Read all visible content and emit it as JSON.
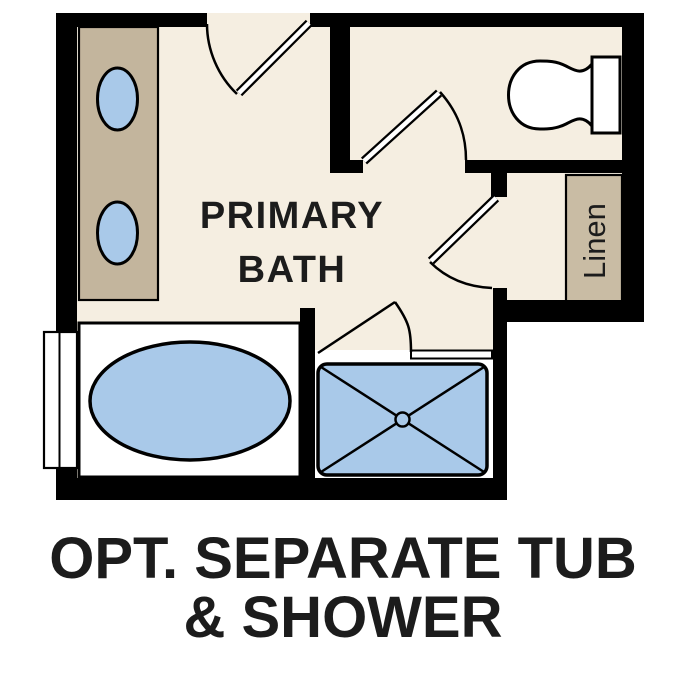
{
  "plan": {
    "room_label": {
      "line1": "PRIMARY",
      "line2": "BATH"
    },
    "linen_label": "Linen",
    "fixture_icons": [
      "double-sink-vanity-icon",
      "soaking-tub-icon",
      "walk-in-shower-icon",
      "toilet-icon",
      "linen-closet-icon",
      "window-icon",
      "door-swing-icon"
    ],
    "door_count": 4
  },
  "caption": {
    "line1": "OPT. SEPARATE TUB",
    "line2": "& SHOWER"
  },
  "colors": {
    "background": "#ffffff",
    "floor": "#f5eee1",
    "vanity": "#c3b59d",
    "linen": "#c9bca4",
    "fixture_blue": "#a9c9e9",
    "wall": "#000000",
    "text": "#1c1c1c"
  }
}
